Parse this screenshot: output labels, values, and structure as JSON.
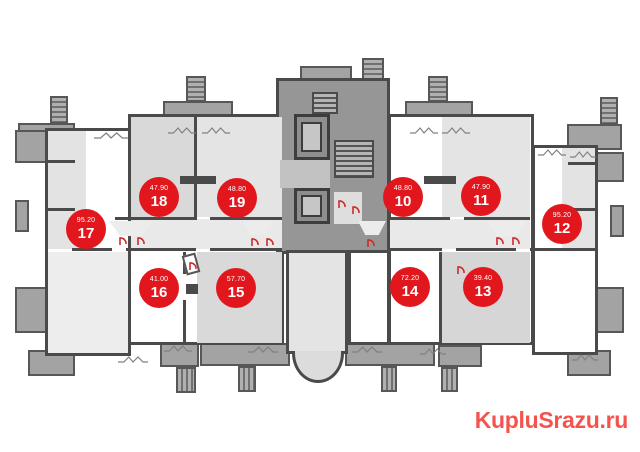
{
  "site": {
    "watermark_text": "KupluSrazu.ru",
    "watermark_color": "#f4534e"
  },
  "floorplan": {
    "type": "residential-floor-plan",
    "badge_color": "#e2171d",
    "badge_text_color": "#ffffff",
    "units": [
      {
        "number": "17",
        "area": "95.20",
        "x": 86,
        "y": 229
      },
      {
        "number": "18",
        "area": "47.90",
        "x": 159,
        "y": 197
      },
      {
        "number": "19",
        "area": "48.80",
        "x": 237,
        "y": 198
      },
      {
        "number": "16",
        "area": "41.00",
        "x": 159,
        "y": 288
      },
      {
        "number": "15",
        "area": "57.70",
        "x": 236,
        "y": 288
      },
      {
        "number": "10",
        "area": "48.80",
        "x": 403,
        "y": 197
      },
      {
        "number": "11",
        "area": "47.90",
        "x": 481,
        "y": 196
      },
      {
        "number": "12",
        "area": "95.20",
        "x": 562,
        "y": 224
      },
      {
        "number": "14",
        "area": "72.20",
        "x": 410,
        "y": 287
      },
      {
        "number": "13",
        "area": "39.40",
        "x": 483,
        "y": 287
      }
    ]
  }
}
